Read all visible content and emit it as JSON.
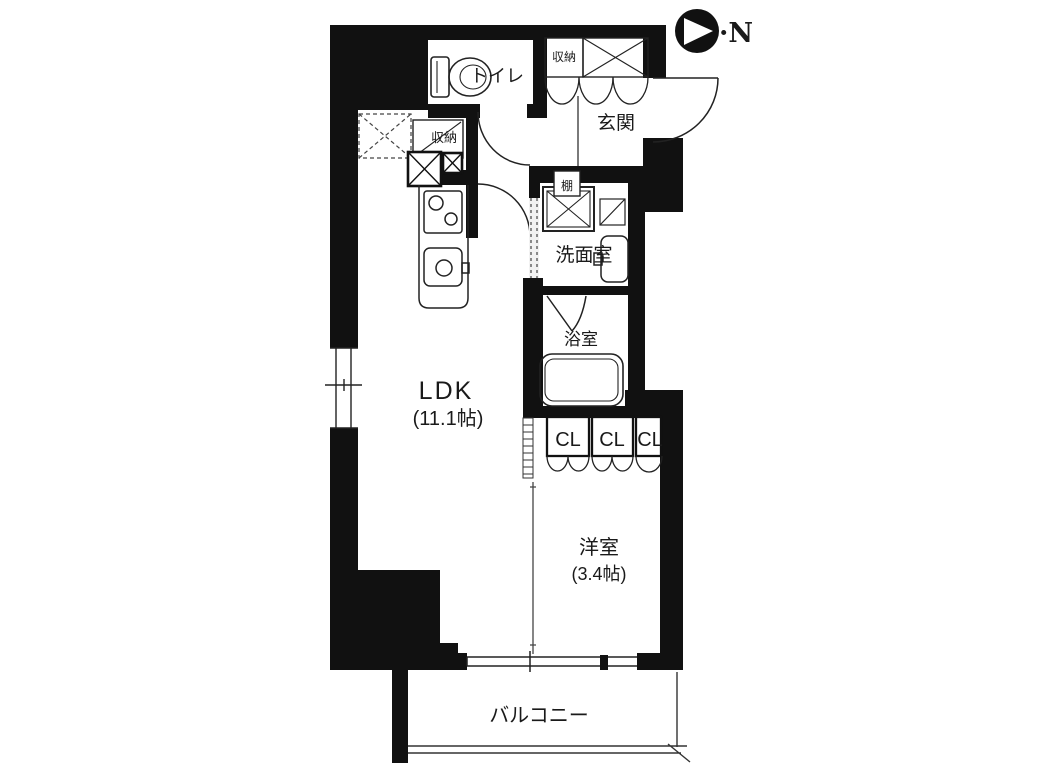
{
  "plan": {
    "rooms": {
      "toilet": "トイレ",
      "storage_top": "収納",
      "entrance": "玄関",
      "storage_kitchen": "収納",
      "shelf": "棚",
      "washroom": "洗面室",
      "bathroom": "浴室",
      "ldk_name": "LDK",
      "ldk_size": "(11.1帖)",
      "closet_1": "CL",
      "closet_2": "CL",
      "closet_3": "CL",
      "western_name": "洋室",
      "western_size": "(3.4帖)",
      "balcony": "バルコニー"
    },
    "compass": "·N",
    "colors": {
      "wall": "#111111",
      "background": "#ffffff",
      "line": "#222222"
    }
  }
}
